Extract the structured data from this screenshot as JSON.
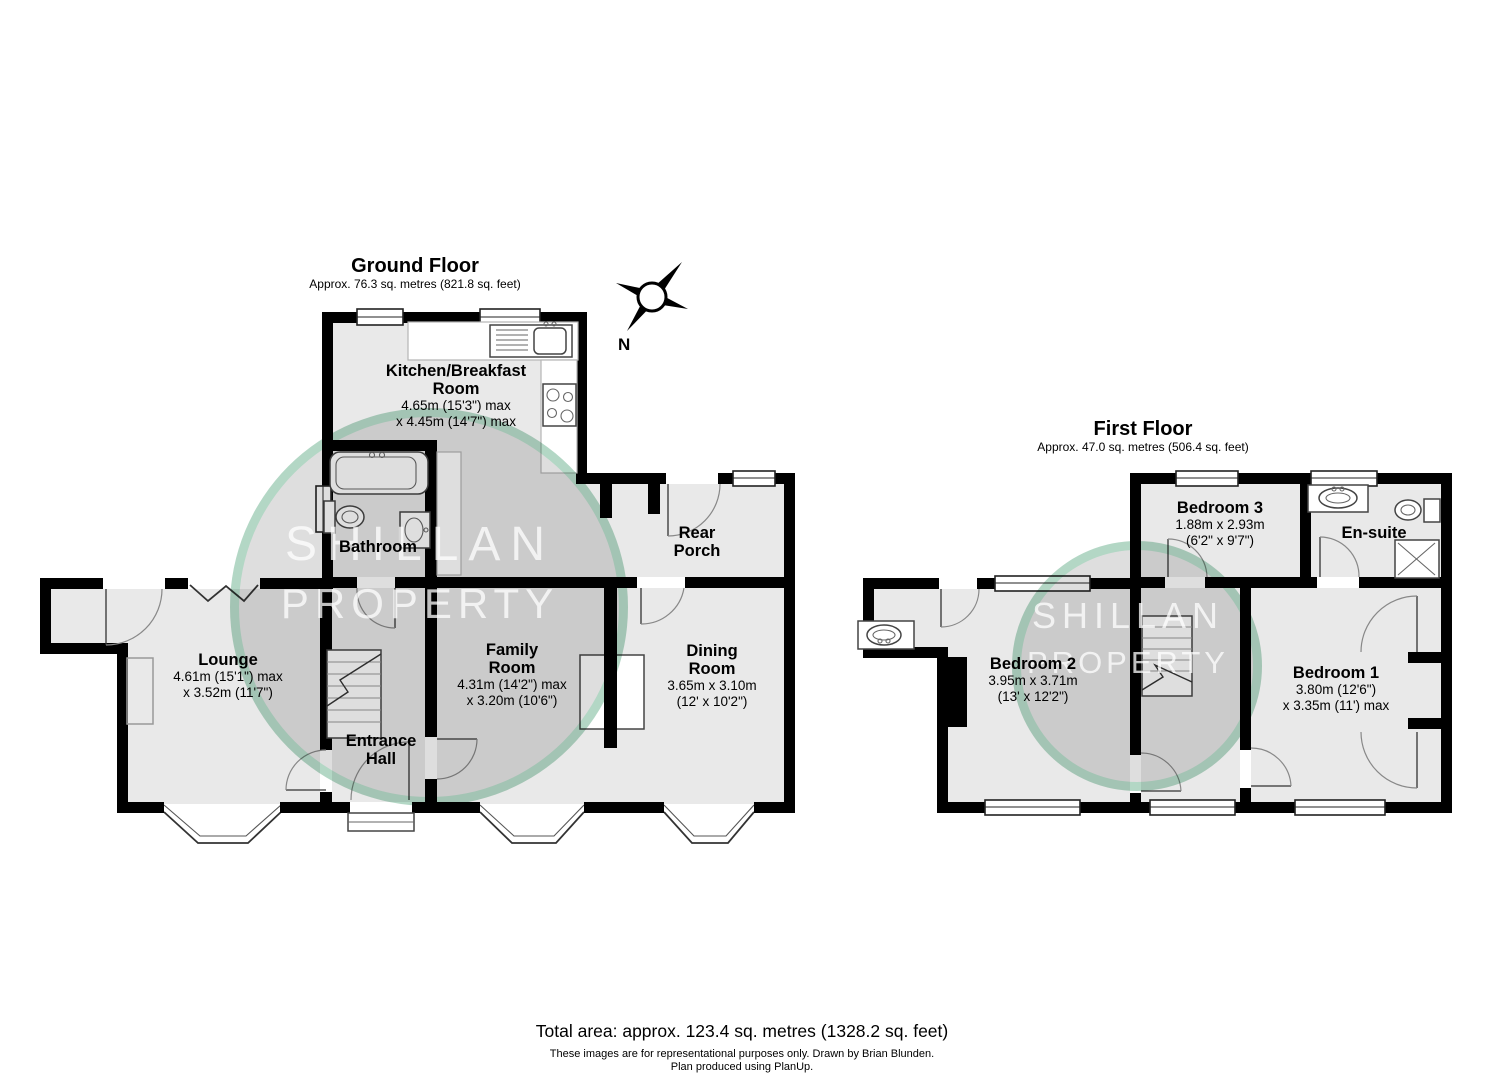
{
  "ground_floor": {
    "title": "Ground Floor",
    "subtitle": "Approx. 76.3 sq. metres (821.8 sq. feet)",
    "rooms": [
      {
        "id": "kitchen",
        "line1": "Kitchen/Breakfast",
        "line2": "Room",
        "dim1": "4.65m (15'3\") max",
        "dim2": "x 4.45m (14'7\") max"
      },
      {
        "id": "bathroom",
        "line1": "Bathroom"
      },
      {
        "id": "rear-porch",
        "line1": "Rear",
        "line2": "Porch"
      },
      {
        "id": "lounge",
        "line1": "Lounge",
        "dim1": "4.61m (15'1\") max",
        "dim2": "x 3.52m (11'7\")"
      },
      {
        "id": "family-room",
        "line1": "Family",
        "line2": "Room",
        "dim1": "4.31m (14'2\") max",
        "dim2": "x 3.20m (10'6\")"
      },
      {
        "id": "dining-room",
        "line1": "Dining",
        "line2": "Room",
        "dim1": "3.65m x 3.10m",
        "dim2": "(12' x 10'2\")"
      },
      {
        "id": "entrance-hall",
        "line1": "Entrance",
        "line2": "Hall"
      }
    ]
  },
  "first_floor": {
    "title": "First Floor",
    "subtitle": "Approx. 47.0 sq. metres (506.4 sq. feet)",
    "rooms": [
      {
        "id": "bedroom-3",
        "line1": "Bedroom 3",
        "dim1": "1.88m x 2.93m",
        "dim2": "(6'2\" x 9'7\")"
      },
      {
        "id": "en-suite",
        "line1": "En-suite"
      },
      {
        "id": "bedroom-2",
        "line1": "Bedroom 2",
        "dim1": "3.95m x 3.71m",
        "dim2": "(13' x 12'2\")"
      },
      {
        "id": "bedroom-1",
        "line1": "Bedroom 1",
        "dim1": "3.80m (12'6\")",
        "dim2": "x 3.35m (11') max"
      }
    ]
  },
  "compass": {
    "north_label": "N"
  },
  "watermark": {
    "line1": "SHILLAN",
    "line2": "PROPERTY"
  },
  "footer": {
    "total": "Total area: approx. 123.4 sq. metres (1328.2 sq. feet)",
    "disclaimer": "These images are for representational purposes only. Drawn by Brian Blunden.",
    "produced": "Plan produced using PlanUp."
  },
  "colors": {
    "wall": "#000000",
    "floor": "#e9e9e9",
    "fixture_stroke": "#444444",
    "watermark_ring": "#96d2b4",
    "watermark_text": "#ffffff"
  }
}
